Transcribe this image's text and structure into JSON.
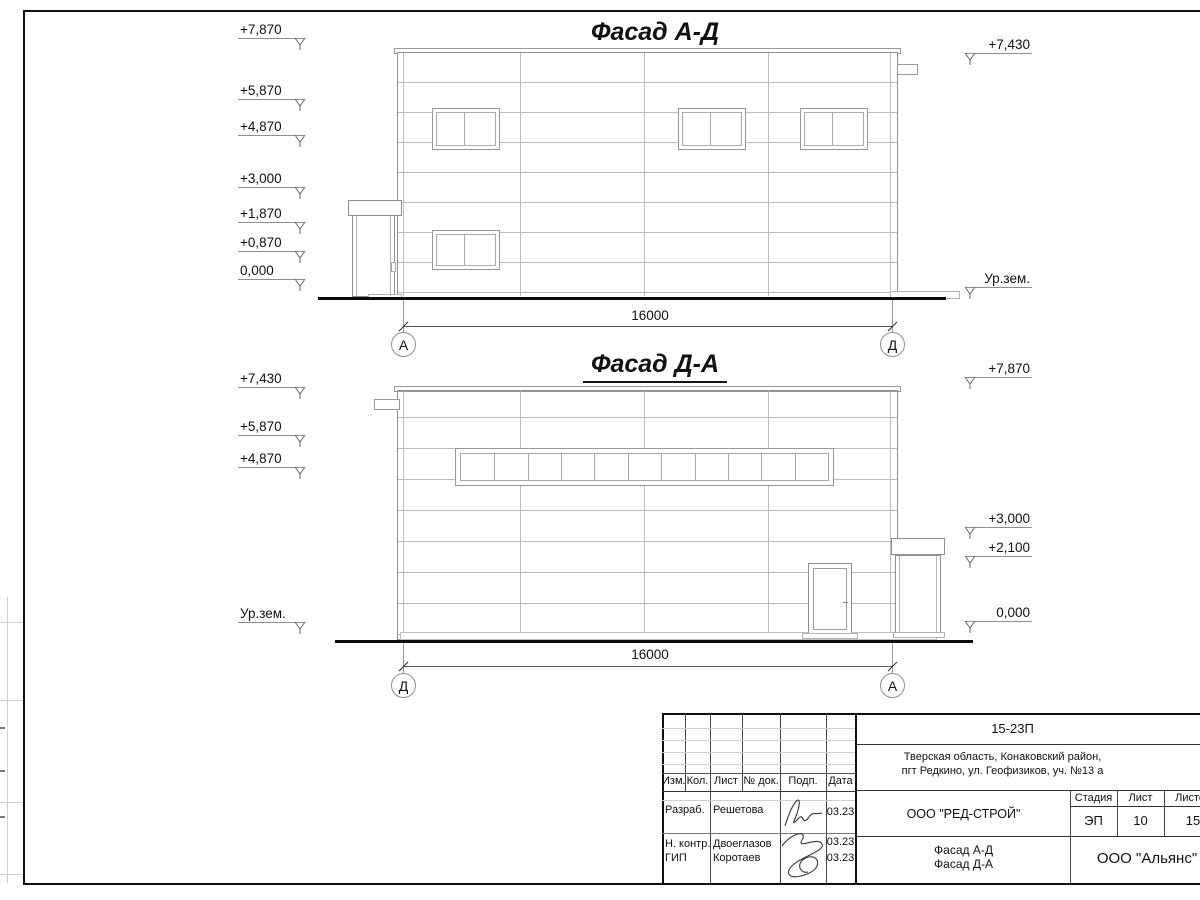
{
  "sheet": {
    "facade1": {
      "title": "Фасад А-Д",
      "dimension": "16000",
      "axis_left": "А",
      "axis_right": "Д",
      "marks_left": [
        {
          "label": "+7,870"
        },
        {
          "label": "+5,870"
        },
        {
          "label": "+4,870"
        },
        {
          "label": "+3,000"
        },
        {
          "label": "+1,870"
        },
        {
          "label": "+0,870"
        },
        {
          "label": "0,000"
        }
      ],
      "marks_right": [
        {
          "label": "+7,430"
        },
        {
          "label": "Ур.зем."
        }
      ]
    },
    "facade2": {
      "title": "Фасад Д-А",
      "dimension": "16000",
      "axis_left": "Д",
      "axis_right": "А",
      "ribbon_panes": 11,
      "marks_left": [
        {
          "label": "+7,430"
        },
        {
          "label": "+5,870"
        },
        {
          "label": "+4,870"
        },
        {
          "label": "Ур.зем."
        }
      ],
      "marks_right": [
        {
          "label": "+7,870"
        },
        {
          "label": "+3,000"
        },
        {
          "label": "+2,100"
        },
        {
          "label": "0,000"
        }
      ]
    },
    "title_block": {
      "code": "15-23П",
      "address_line1": "Тверская область, Конаковский район,",
      "address_line2": "пгт Редкино, ул. Геофизиков, уч. №13 а",
      "designer_company": "ООО \"РЕД-СТРОЙ\"",
      "doc_title_line1": "Фасад А-Д",
      "doc_title_line2": "Фасад Д-А",
      "org": "ООО \"Альянс\"",
      "col_headers": {
        "izm": "Изм.",
        "kol": "Кол.",
        "list": "Лист",
        "ndok": "№ док.",
        "podp": "Подп.",
        "data": "Дата"
      },
      "stage_headers": {
        "stage": "Стадия",
        "sheet": "Лист",
        "sheets": "Листов"
      },
      "stage": "ЭП",
      "sheet_num": "10",
      "sheets_total": "15",
      "rows": [
        {
          "role": "Разраб.",
          "name": "Решетова",
          "date": "03.23"
        },
        {
          "role": "Н. контр.",
          "name": "Двоеглазов",
          "date": "03.23"
        },
        {
          "role": "ГИП",
          "name": "Коротаев",
          "date": "03.23"
        }
      ]
    }
  }
}
